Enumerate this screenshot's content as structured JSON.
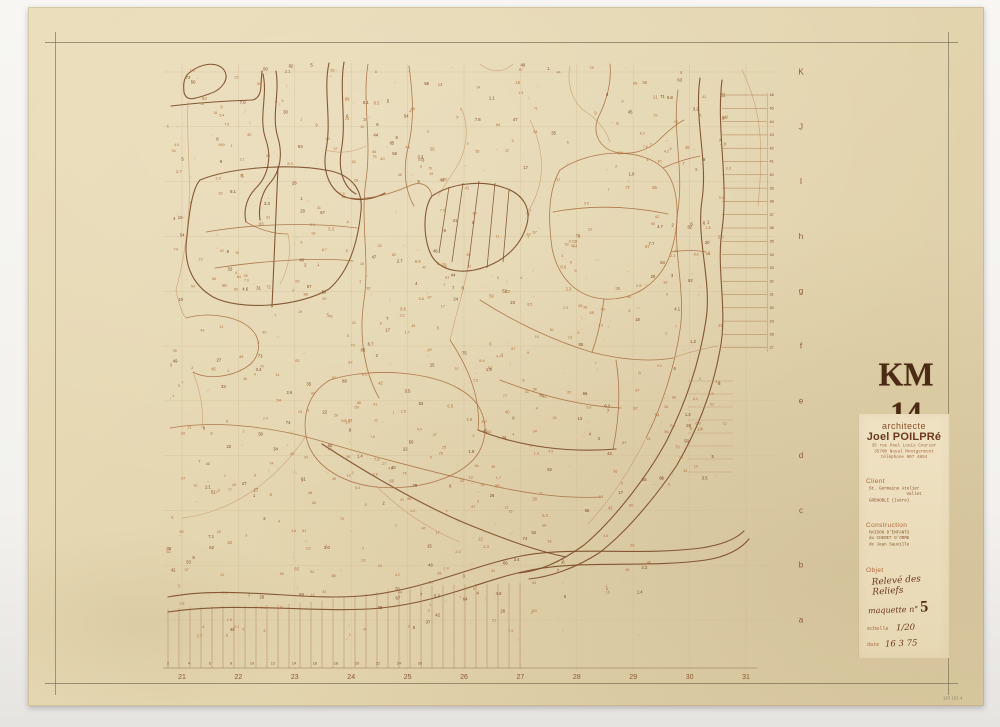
{
  "stamp": {
    "text": "KM 14",
    "color": "#4a2a14"
  },
  "axes": {
    "bottom_numbers": [
      "21",
      "22",
      "23",
      "24",
      "25",
      "26",
      "27",
      "28",
      "29",
      "30",
      "31"
    ],
    "right_letters": [
      "K",
      "J",
      "I",
      "h",
      "g",
      "f",
      "e",
      "d",
      "c",
      "b",
      "a"
    ]
  },
  "title_block": {
    "profession": "architecte",
    "name": "Joel POILPRé",
    "address": [
      "35 rue Paul Louis Courier",
      "35700 Noyal Montgermont",
      "téléphone 907 4854"
    ],
    "client_label": "Client",
    "client_lines": [
      "St. Germaine Atelier",
      "Vallet",
      "GRENOBLE (Isère)"
    ],
    "construction_label": "Construction",
    "construction_lines": [
      "MAISON D'ENFANTS",
      "du CHERET D'ORME",
      "de Jean Sauville"
    ],
    "objet_label": "Objet",
    "objet_hand": [
      "Relevé des",
      "Reliefs"
    ],
    "maquette_label": "maquette n°",
    "maquette_number": "5",
    "echelle_label": "echelle",
    "echelle_value": "1/20",
    "date_label": "date",
    "date_value": "16 3 75",
    "modifie_label": "modifié le"
  },
  "caption": {
    "line1": "193 161 4",
    "line2": "· · ·"
  },
  "map": {
    "colors": {
      "dark": "#7a4a26",
      "mid": "#a4683a",
      "light": "#c28f60",
      "grid": "#cdb88e",
      "axis": "#8a5730",
      "scatter_light": "#b5713f",
      "scatter_dark": "#7f4a26",
      "frame": "#6f6754",
      "ruler": "#8a6a3e"
    },
    "frame_lines": [
      [
        55.5,
        32,
        55.5,
        695
      ],
      [
        948.5,
        32,
        948.5,
        695
      ],
      [
        45,
        42.5,
        958,
        42.5
      ],
      [
        45,
        683.5,
        958,
        683.5
      ]
    ],
    "grid": {
      "xs": [
        182,
        238.4,
        294.8,
        351.2,
        407.6,
        464,
        520.4,
        576.8,
        633.2,
        689.6,
        746
      ],
      "ys": [
        72,
        126.8,
        181.6,
        236.4,
        291.2,
        346,
        400.8,
        455.6,
        510.4,
        565.2,
        620
      ],
      "ytop": 63,
      "ybot": 670,
      "xleft": 163,
      "xright": 774
    },
    "paths": [
      {
        "k": "dark",
        "d": "M189,73 C201,63 217,61 224,70 C230,79 222,90 209,94 C197,98 186,103 184,92 C183,84 184,77 189,73"
      },
      {
        "k": "dark",
        "d": "M171,106 C196,103 226,101 252,100 C259,99 261,92 261,84 L262,71"
      },
      {
        "k": "dark",
        "d": "M263,74 C268,96 258,118 266,140 C272,158 268,176 256,188 C247,197 243,210 246,222"
      },
      {
        "k": "dark",
        "d": "M276,71 C280,94 271,116 278,138 C283,155 280,172 270,183 C262,192 258,206 260,220"
      },
      {
        "k": "dark",
        "d": "M329,63 C323,90 332,120 326,150 C322,172 330,189 343,196 C356,202 372,200 385,193"
      },
      {
        "k": "dark",
        "d": "M344,62 C339,92 347,122 341,152 C338,173 345,188 356,194"
      },
      {
        "k": "dark",
        "d": "M200,180 C232,167 292,163 331,171 C352,176 363,190 361,211 C358,241 350,271 329,289 C299,307 240,311 213,297 C191,284 183,262 187,236 C189,214 192,189 200,180"
      },
      {
        "k": "dark",
        "d": "M278,167 C276,212 274,258 272,307"
      },
      {
        "k": "dark",
        "d": "M478,430 C520,447 570,453 616,449"
      },
      {
        "k": "dark",
        "d": "M322,444 C362,470 422,506 472,526 C512,542 541,552 566,557"
      },
      {
        "k": "dark",
        "d": "M700,78 C694,120 708,160 702,200 C696,240 712,280 706,320 C700,360 687,400 667,440 C649,474 614,520 584,545 C559,563 539,571 519,573"
      },
      {
        "k": "dark",
        "d": "M722,80 C716,130 729,180 722,230 C716,270 728,310 720,350 C712,394 697,430 677,465 C659,492 629,530 599,553 C574,569 549,577 529,579"
      },
      {
        "k": "dark",
        "d": "M168,597 C230,585 301,601 361,596 C421,591 471,566 521,556 C571,546 641,556 701,548 C721,545 736,539 744,531"
      },
      {
        "k": "dark",
        "d": "M168,612 C241,601 321,614 381,608 C441,602 481,580 531,570 C581,560 651,568 706,560 C726,557 741,549 749,539"
      },
      {
        "k": "mid",
        "d": "M678,90 C672,130 684,170 678,210 C672,250 686,290 680,330 C674,370 661,408 646,438"
      },
      {
        "k": "mid",
        "d": "M560,170 C590,149 641,147 663,168 C679,184 681,220 671,252 C661,283 634,301 604,299 C577,297 558,278 552,248 C548,219 548,191 560,170"
      },
      {
        "k": "mid",
        "d": "M553,212 C590,205 630,206 668,214"
      },
      {
        "k": "mid",
        "d": "M330,380 C371,367 431,371 461,390 C485,404 491,430 479,452 C464,477 420,491 376,487 C340,483 311,464 306,436 C302,411 311,391 330,380"
      },
      {
        "k": "mid",
        "d": "M186,318 C211,311 241,317 253,331 C263,343 259,360 245,368 C230,377 207,380 193,372"
      },
      {
        "k": "mid",
        "d": "M170,428 C221,419 281,429 321,441 C361,453 421,469 471,481 C521,493 561,499 601,497"
      },
      {
        "k": "mid",
        "d": "M368,64 C362,100 372,140 366,180 C360,220 370,260 364,300 C358,340 366,375 379,398"
      },
      {
        "k": "mid",
        "d": "M409,66 C413,96 415,122 407,152 C403,174 406,192 414,206"
      },
      {
        "k": "mid",
        "d": "M342,197 C362,201 384,197 409,186 C422,180 430,186 432,196"
      },
      {
        "k": "mid",
        "d": "M598,118 C592,134 600,148 615,152 C631,156 649,150 659,140 C668,131 676,124 684,120"
      },
      {
        "k": "mid",
        "d": "M610,64 C612,84 606,102 598,118"
      },
      {
        "k": "mid",
        "d": "M480,300 C511,320 551,340 591,352 C621,360 651,362 673,358"
      },
      {
        "k": "mid",
        "d": "M500,380 C541,396 581,406 621,408"
      },
      {
        "k": "mid",
        "d": "M450,340 C470,370 481,400 478,430"
      },
      {
        "k": "mid",
        "d": "M616,360 C621,390 619,420 613,449"
      },
      {
        "k": "mid",
        "d": "M206,232 C251,224 311,222 357,228"
      },
      {
        "k": "mid",
        "d": "M215,268 C261,261 317,257 353,261"
      },
      {
        "k": "mid",
        "d": "M246,222 C260,230 274,234 288,234"
      },
      {
        "k": "mid",
        "d": "M592,352 C600,330 602,312 604,299"
      },
      {
        "k": "mid",
        "d": "M663,168 C676,162 690,158 700,156"
      },
      {
        "k": "mid",
        "d": "M671,252 C684,250 696,250 706,252"
      },
      {
        "k": "light",
        "d": "M188,102 C186,140 192,180 188,220 C186,244 182,268 176,290"
      },
      {
        "k": "light",
        "d": "M570,66 C566,86 574,104 586,112 C598,120 606,130 610,142"
      },
      {
        "k": "light",
        "d": "M480,64 C492,74 505,72 513,64"
      },
      {
        "k": "light",
        "d": "M742,70 C752,90 758,110 760,135 C762,160 760,186 758,206"
      },
      {
        "k": "light",
        "d": "M462,110 C470,130 466,152 456,168 C448,180 442,190 438,196"
      },
      {
        "k": "light",
        "d": "M530,120 C540,140 544,162 540,182 C537,196 532,206 526,214"
      },
      {
        "k": "light",
        "d": "M376,486 C400,510 430,530 460,542"
      },
      {
        "k": "light",
        "d": "M306,436 C290,460 270,480 248,494 C226,508 202,516 182,518"
      },
      {
        "k": "light",
        "d": "M645,440 C630,470 610,500 588,524"
      },
      {
        "k": "light",
        "d": "M468,268 C461,300 454,322 450,340"
      },
      {
        "k": "light",
        "d": "M176,290 C180,310 184,316 186,318"
      },
      {
        "k": "light",
        "d": "M193,372 C200,390 204,410 202,428"
      },
      {
        "k": "light",
        "d": "M288,234 C292,252 288,270 280,284"
      },
      {
        "k": "light",
        "d": "M326,150 C340,154 354,152 366,146"
      },
      {
        "k": "light",
        "d": "M672,358 C690,352 706,348 718,346"
      }
    ],
    "hatch_polygon": {
      "outline": "M432,196 C450,184 480,179 505,188 C523,194 531,208 527,224 C522,243 508,258 488,266 C465,275 443,272 433,258 C423,243 422,209 432,196",
      "lines": [
        [
          449,
          187,
          439,
          253
        ],
        [
          463,
          183,
          452,
          262
        ],
        [
          479,
          181,
          468,
          268
        ],
        [
          495,
          183,
          487,
          268
        ],
        [
          509,
          190,
          503,
          262
        ]
      ]
    },
    "band_hatch": {
      "x0": 168,
      "x1": 522,
      "step": 11,
      "ybase": 668,
      "ytopA": 612,
      "slope": -0.09
    },
    "ruler": {
      "x1": 163,
      "x2": 757,
      "y": 668,
      "num_x0": 168,
      "num_dx": 21,
      "num_y": 664.5,
      "numbers": [
        "2",
        "4",
        "6",
        "8",
        "10",
        "12",
        "14",
        "16",
        "18",
        "20",
        "22",
        "24",
        "26"
      ]
    },
    "ladder_upper": {
      "x1": 722,
      "x2": 767,
      "y0": 95,
      "dy": 13.3,
      "n": 20,
      "num_x": 769.5,
      "vline": [
        767.5,
        93,
        352
      ],
      "numbers": [
        "46",
        "45",
        "44",
        "43",
        "42",
        "41",
        "40",
        "39",
        "38",
        "37",
        "36",
        "35",
        "34",
        "33",
        "32",
        "31",
        "30",
        "29",
        "28",
        "27"
      ]
    },
    "ladder_lower": {
      "x1": 688,
      "x2": 733,
      "y0": 381,
      "dy": 13,
      "n": 8
    },
    "axis_pos": {
      "bottom_y": 679,
      "letters_x": 801
    },
    "scatter": {
      "count": 640,
      "seed": 11,
      "segs": 160,
      "xmin": 166,
      "xmax": 730,
      "ymin": 66,
      "ymax": 640
    }
  }
}
